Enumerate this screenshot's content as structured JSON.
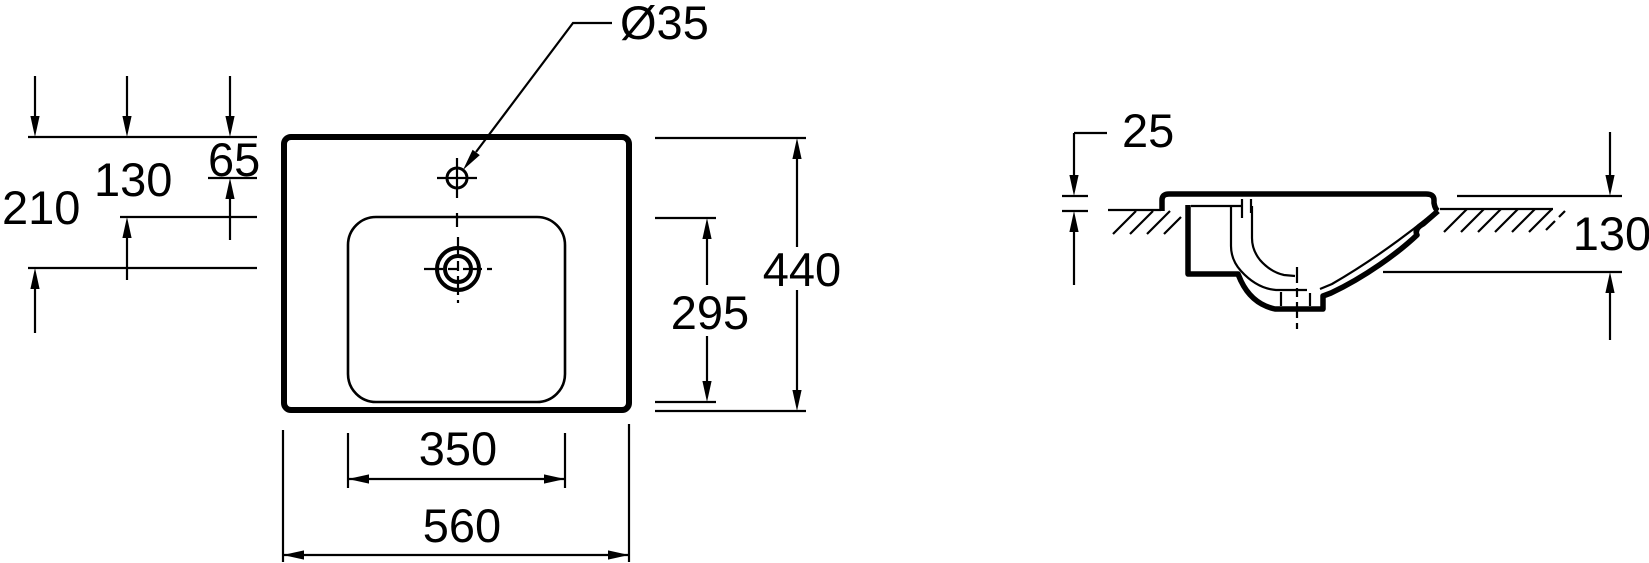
{
  "colors": {
    "ink": "#000000",
    "paper": "#ffffff"
  },
  "views": {
    "top": {
      "dims": {
        "faucet_hole_diameter": "Ø35",
        "drain_center_offset": "210",
        "basin_front_offset": "130",
        "faucet_center_offset": "65",
        "overall_depth": "440",
        "basin_depth": "295",
        "basin_width": "350",
        "overall_width": "560"
      }
    },
    "side": {
      "dims": {
        "rim_above_counter": "25",
        "height_below_rim": "130"
      }
    }
  }
}
